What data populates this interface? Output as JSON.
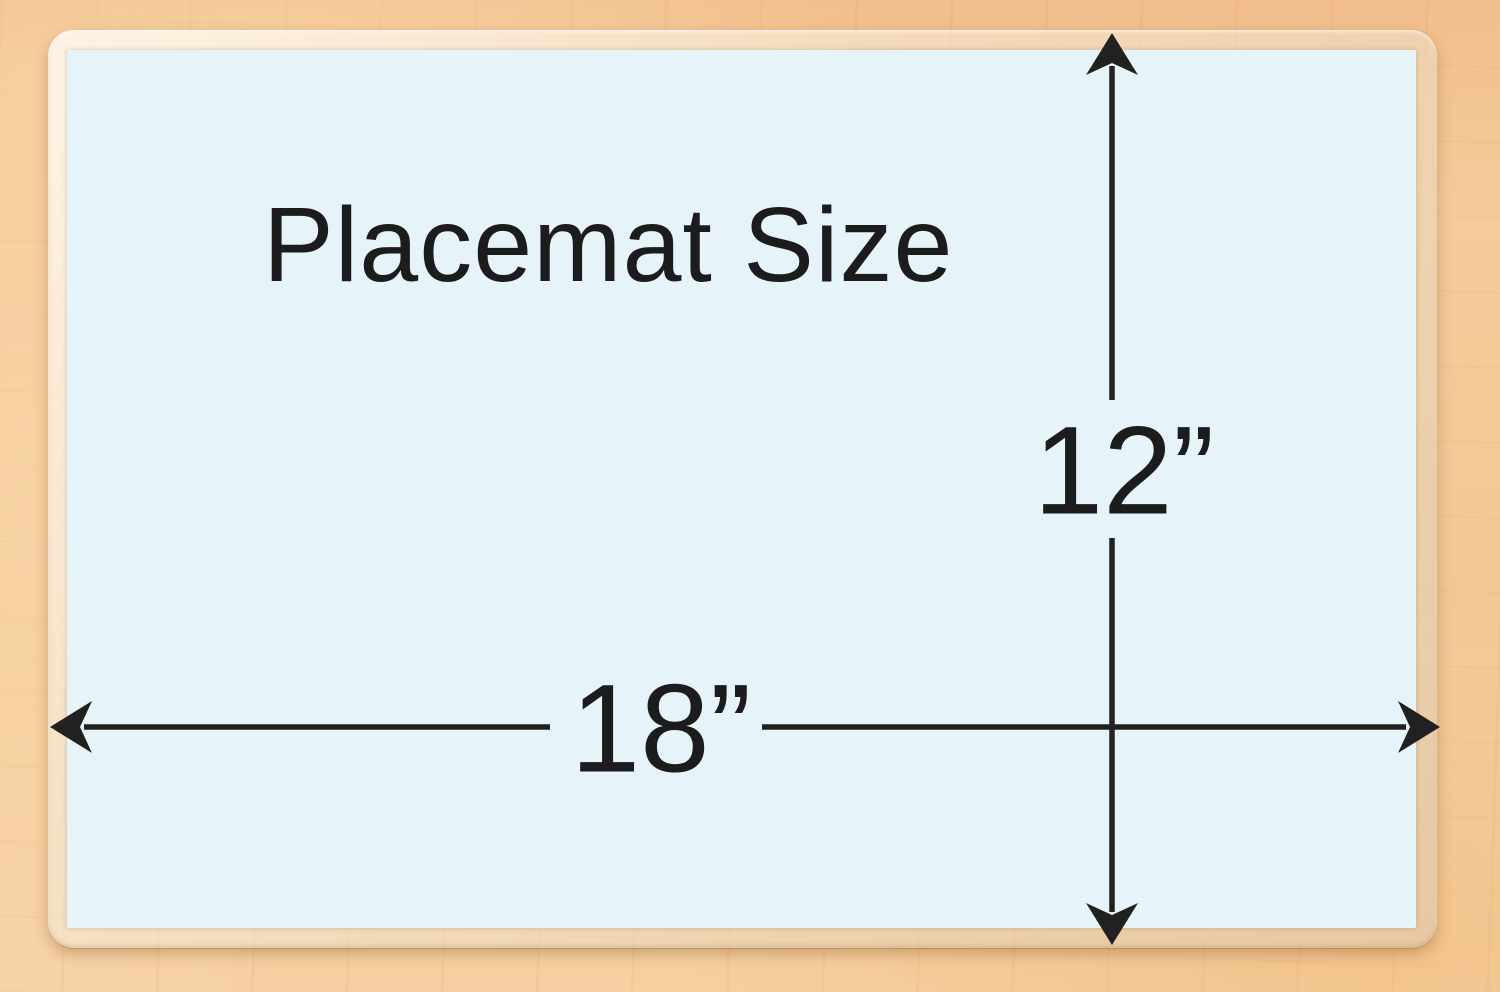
{
  "diagram": {
    "title": "Placemat Size",
    "width_label": "18”",
    "height_label": "12”",
    "width_inches": 18,
    "height_inches": 12
  },
  "colors": {
    "mat_fill": "#E6F4FA",
    "laminate_edge": "#F4E9D8",
    "wood": "#F3C795",
    "line": "#212121",
    "text": "#1C1C1E"
  },
  "icons": {
    "up": "arrow-up-icon",
    "down": "arrow-down-icon",
    "left": "arrow-left-icon",
    "right": "arrow-right-icon"
  }
}
